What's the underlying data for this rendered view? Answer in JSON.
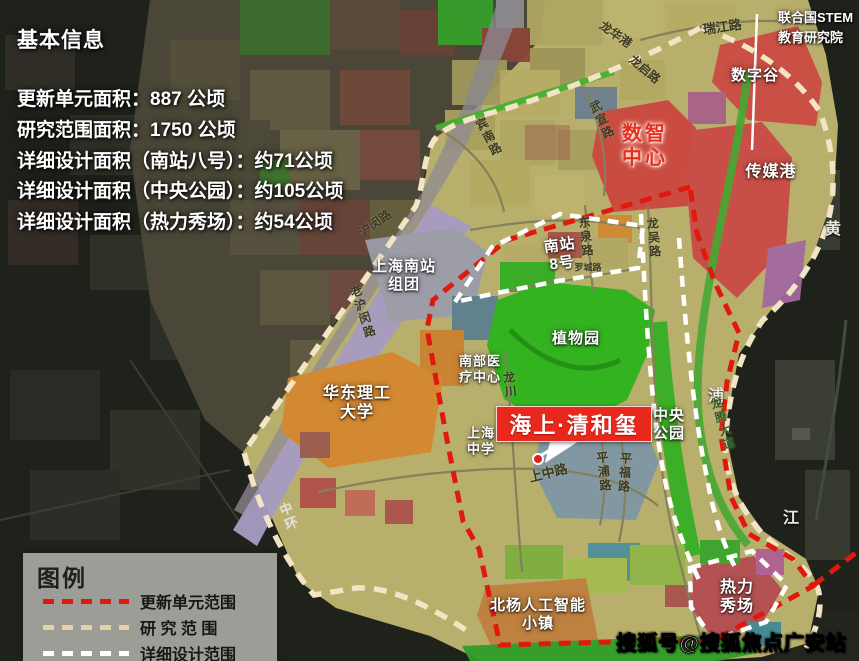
{
  "info_panel": {
    "title": "基本信息",
    "lines": [
      "更新单元面积：887 公顷",
      "研究范围面积：1750 公顷",
      "详细设计面积（南站八号）：约71公顷",
      "详细设计面积（中央公园）：约105公顷",
      "详细设计面积（热力秀场）：约54公顷"
    ]
  },
  "callouts": {
    "stem_institute": "联合国STEM\n教育研究院",
    "project_name": "海上·清和玺"
  },
  "zone_labels": {
    "digital_valley": "数字谷",
    "digital_center": "数智\n中心",
    "media_port": "传媒港",
    "south_station_8": "南站\n8号",
    "botanical_garden": "植物园",
    "south_station_cluster": "上海南站\n组团",
    "ecust_university": "华东理工\n大学",
    "south_medical_center": "南部医\n疗中心",
    "shanghai_high_school": "上海\n中学",
    "central_park": "中央\n公园",
    "thermal_show": "热力\n秀场",
    "beiyang_ai_town": "北杨人工智能\n小镇"
  },
  "river_labels": {
    "huang": "黄",
    "pu": "浦",
    "jiang": "江"
  },
  "road_labels": {
    "ruijiang_rd": "瑞江路",
    "longhua_port": "龙华港",
    "longqi_rd": "龙启路",
    "binnan_rd": "宾南路",
    "wuxuan_rd": "武宣路",
    "humin_rd": "沪闵路",
    "lao_humin_rd": "老沪闵路",
    "dongquan_rd": "东泉路",
    "luocheng_rd": "罗城路",
    "longwu_rd": "龙吴路",
    "longchuan_rd": "龙川",
    "shangzhong_rd": "上中路",
    "pingpu_rd": "平浦路",
    "pingfu_rd": "平福路",
    "longteng_ave": "龙腾大道",
    "middle_ring": "中环"
  },
  "legend": {
    "title": "图例",
    "items": [
      {
        "label": "更新单元范围",
        "color": "#e0190f"
      },
      {
        "label": "研 究 范 围",
        "color": "#e6d2a6"
      },
      {
        "label": "详细设计范围",
        "color": "#ffffff"
      }
    ]
  },
  "watermark": "搜狐号@搜狐焦点广安站",
  "colors": {
    "update_unit_boundary": "#e0190f",
    "research_boundary": "#f2e4c4",
    "detail_design_boundary": "#ffffff",
    "project_banner_red": "#e8281c",
    "redevelop_zone_red": "#cb4a42",
    "park_green": "#2db41c",
    "campus_orange": "#d5872e",
    "rail_lavender": "#a79cc3",
    "map_base_khaki": "#b9af6d"
  }
}
